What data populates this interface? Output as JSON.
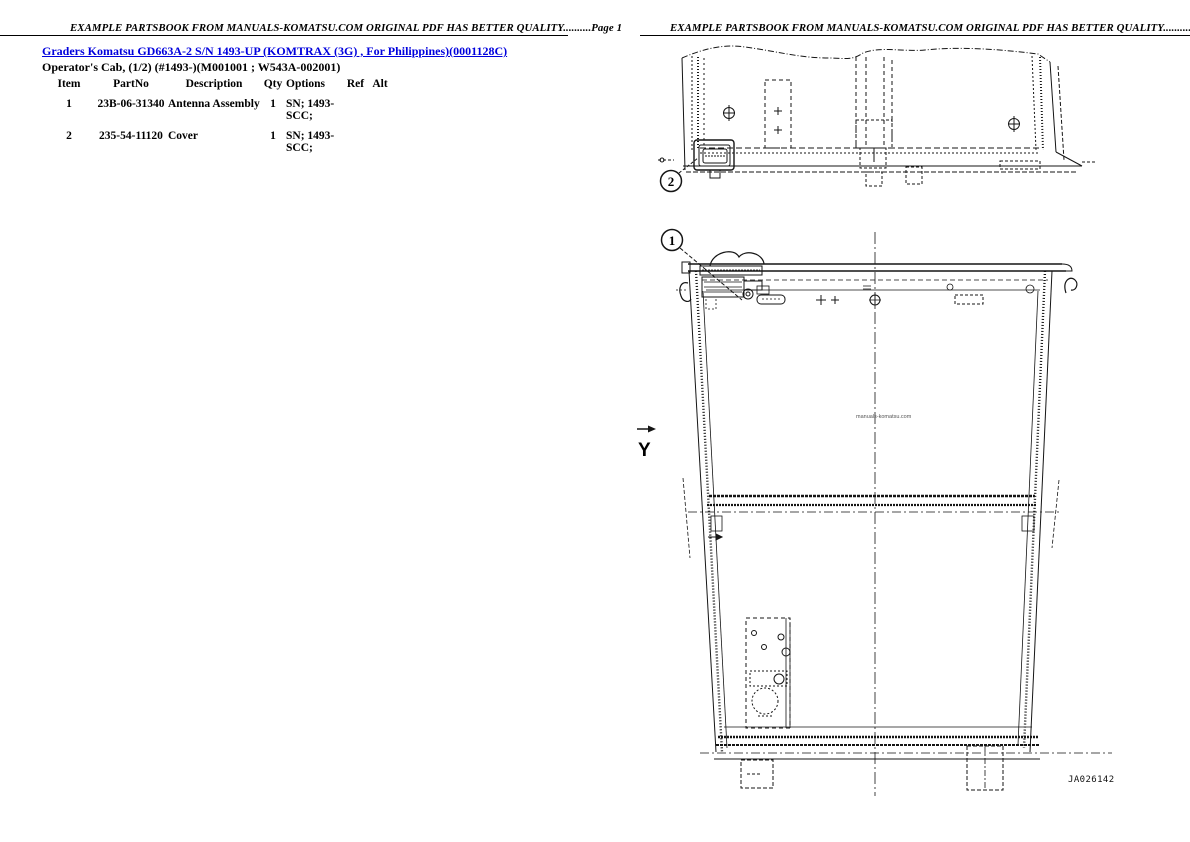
{
  "page1": {
    "header": "EXAMPLE PARTSBOOK FROM MANUALS-KOMATSU.COM ORIGINAL PDF HAS BETTER QUALITY..........Page 1",
    "title_link": "Graders Komatsu GD663A-2 S/N 1493-UP (KOMTRAX (3G) , For Philippines)(0001128C)",
    "subtitle": "Operator's Cab, (1/2) (#1493-)(M001001 ; W543A-002001)",
    "table": {
      "headers": {
        "item": "Item",
        "part_no": "PartNo",
        "description": "Description",
        "qty": "Qty",
        "options": "Options",
        "ref": "Ref",
        "alt": "Alt"
      },
      "rows": [
        {
          "item": "1",
          "part_no": "23B-06-31340",
          "description": "Antenna Assembly",
          "qty": "1",
          "options_line1": "SN; 1493-",
          "options_line2": "SCC;",
          "ref": "",
          "alt": ""
        },
        {
          "item": "2",
          "part_no": "235-54-11120",
          "description": "Cover",
          "qty": "1",
          "options_line1": "SN; 1493-",
          "options_line2": "SCC;",
          "ref": "",
          "alt": ""
        }
      ]
    }
  },
  "page2": {
    "header": "EXAMPLE PARTSBOOK FROM MANUALS-KOMATSU.COM ORIGINAL PDF HAS BETTER QUALITY..........Page 2",
    "callouts": {
      "item1": "1",
      "item2": "2"
    },
    "axis_label": "Y",
    "watermark": "manuals-komatsu.com",
    "figure_code": "JA026142"
  },
  "colors": {
    "link": "#0000dd",
    "ink": "#151515"
  }
}
